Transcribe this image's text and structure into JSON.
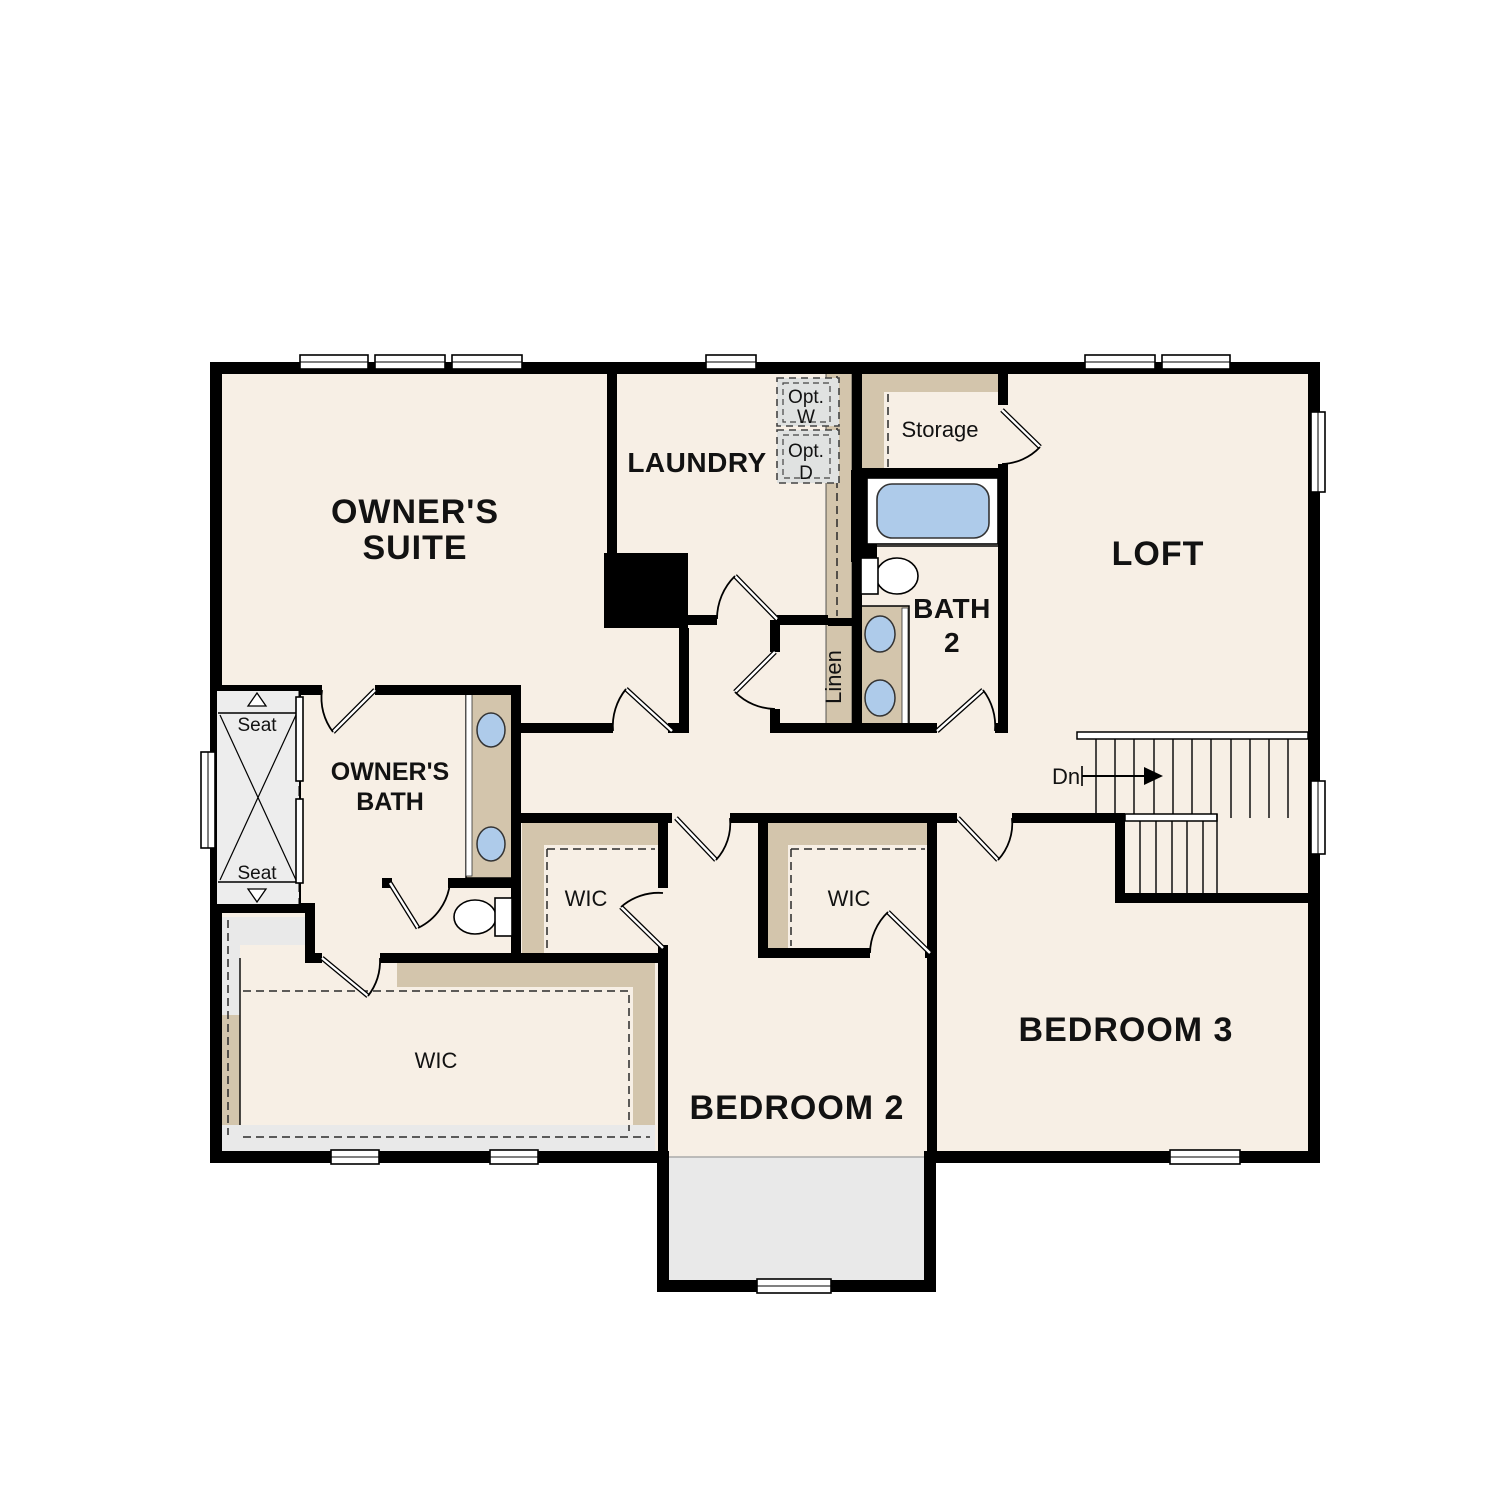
{
  "rooms": {
    "owners_suite": {
      "line1": "OWNER'S",
      "line2": "SUITE"
    },
    "laundry": {
      "label": "LAUNDRY"
    },
    "loft": {
      "label": "LOFT"
    },
    "storage": {
      "label": "Storage"
    },
    "bath2": {
      "line1": "BATH",
      "line2": "2"
    },
    "linen": {
      "label": "Linen"
    },
    "owners_bath": {
      "line1": "OWNER'S",
      "line2": "BATH"
    },
    "wic_owners": {
      "label": "WIC"
    },
    "wic_bedroom2_left": {
      "label": "WIC"
    },
    "wic_bedroom2_right": {
      "label": "WIC"
    },
    "bedroom2": {
      "label": "BEDROOM 2"
    },
    "bedroom3": {
      "label": "BEDROOM 3"
    }
  },
  "annotations": {
    "seat_top": "Seat",
    "seat_bottom": "Seat",
    "opt_washer_line1": "Opt.",
    "opt_washer_line2": "W",
    "opt_dryer_line1": "Opt.",
    "opt_dryer_line2": "D",
    "stairs_down": "Dn"
  },
  "colors": {
    "floor_cream": "#f7efe5",
    "accent_tan": "#d3c5ac",
    "accent_gray": "#e9e9e9",
    "shower_gray": "#ededed",
    "optional_fill": "#e0e2e1",
    "fixture_blue": "#aecbea",
    "wall_black": "#000000"
  }
}
